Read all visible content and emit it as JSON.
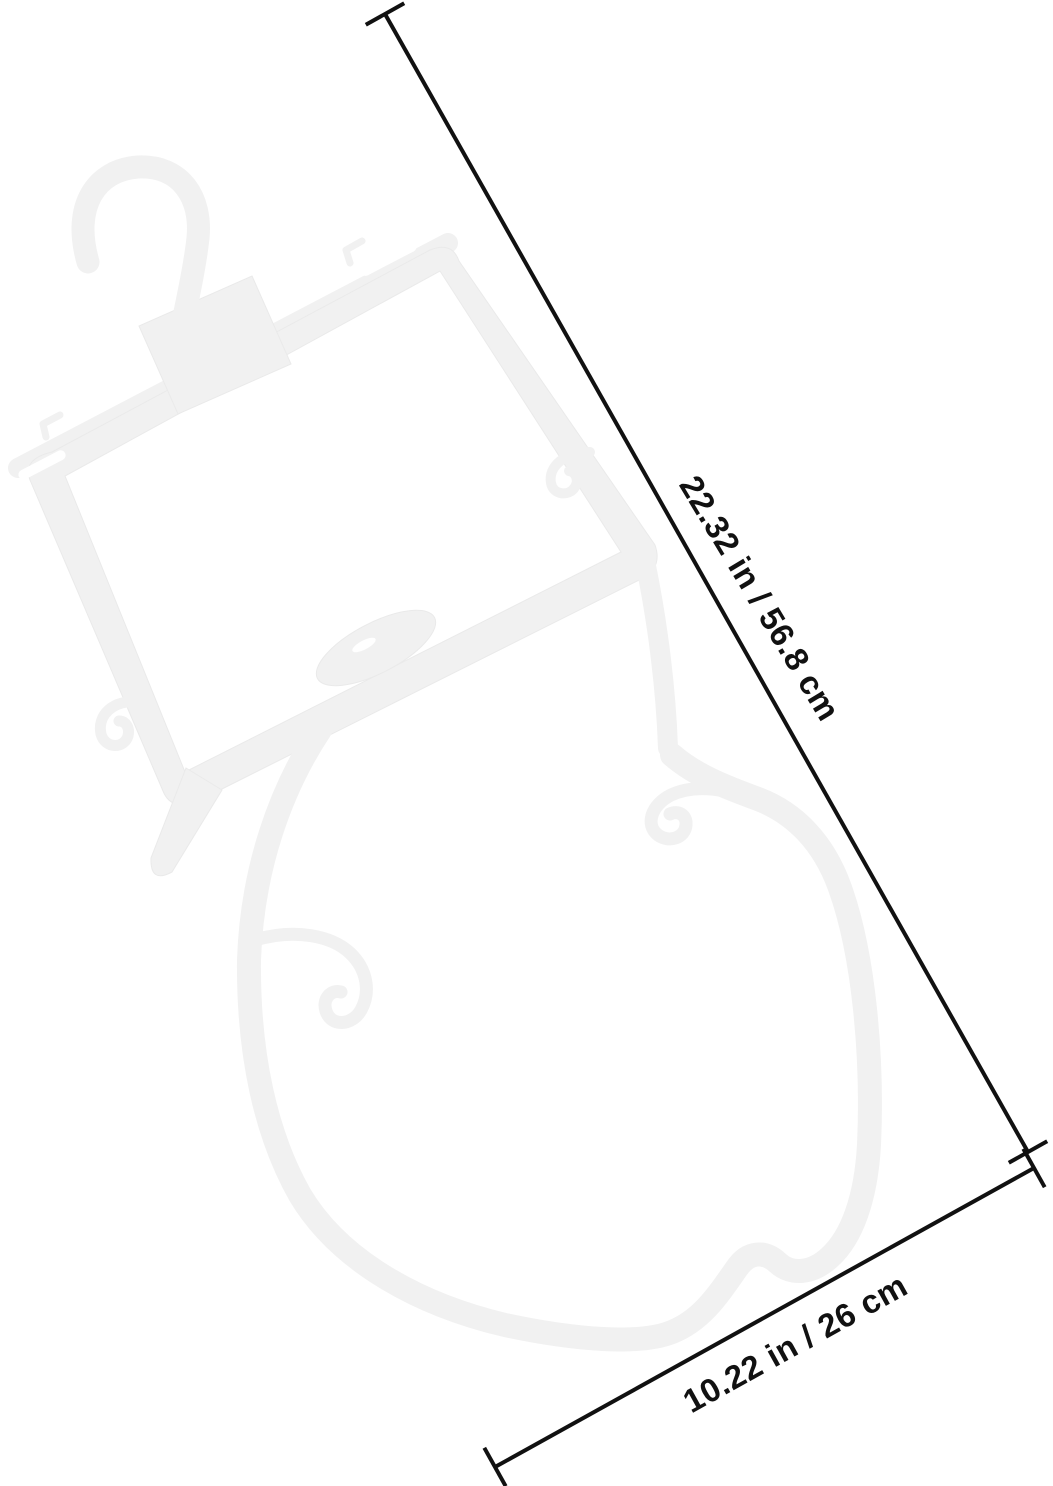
{
  "background_color": "#ffffff",
  "hanger": {
    "description": "white plastic hanger with top hook, rectangular upper frame and large lower loop",
    "color": "#f1f1f1",
    "slot_color": "#ffffff"
  },
  "annotations": {
    "length_label": "22.32 in / 56.8 cm",
    "width_label": "10.22 in / 26 cm",
    "line_color": "#111111",
    "label_color": "#111111"
  }
}
